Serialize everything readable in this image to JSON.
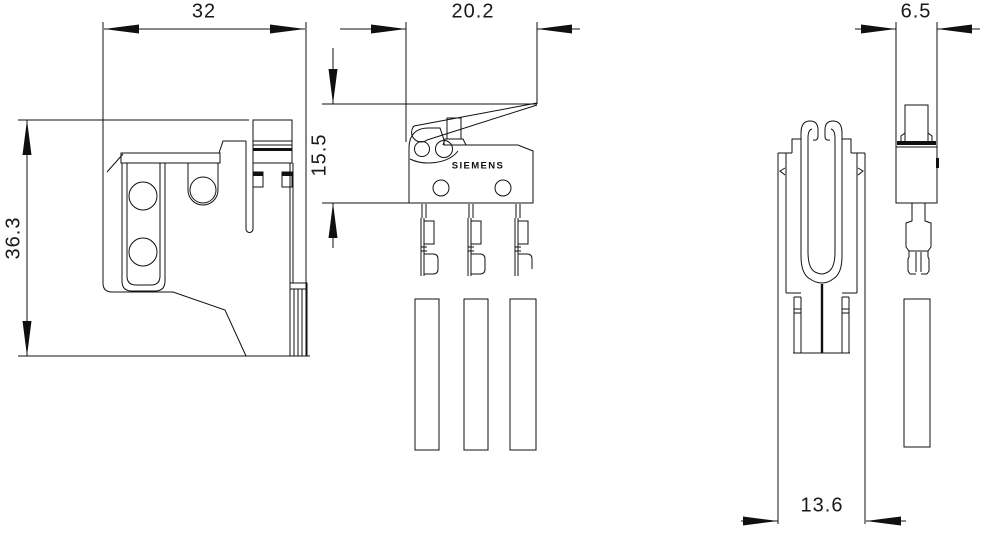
{
  "drawing": {
    "brand_label": "SIEMENS",
    "dimensions": {
      "front_width": "32",
      "front_height": "36.3",
      "switch_width": "20.2",
      "switch_height": "15.5",
      "side_width": "6.5",
      "side_housing_width": "13.6"
    },
    "colors": {
      "line": "#101010",
      "background": "#ffffff"
    }
  }
}
